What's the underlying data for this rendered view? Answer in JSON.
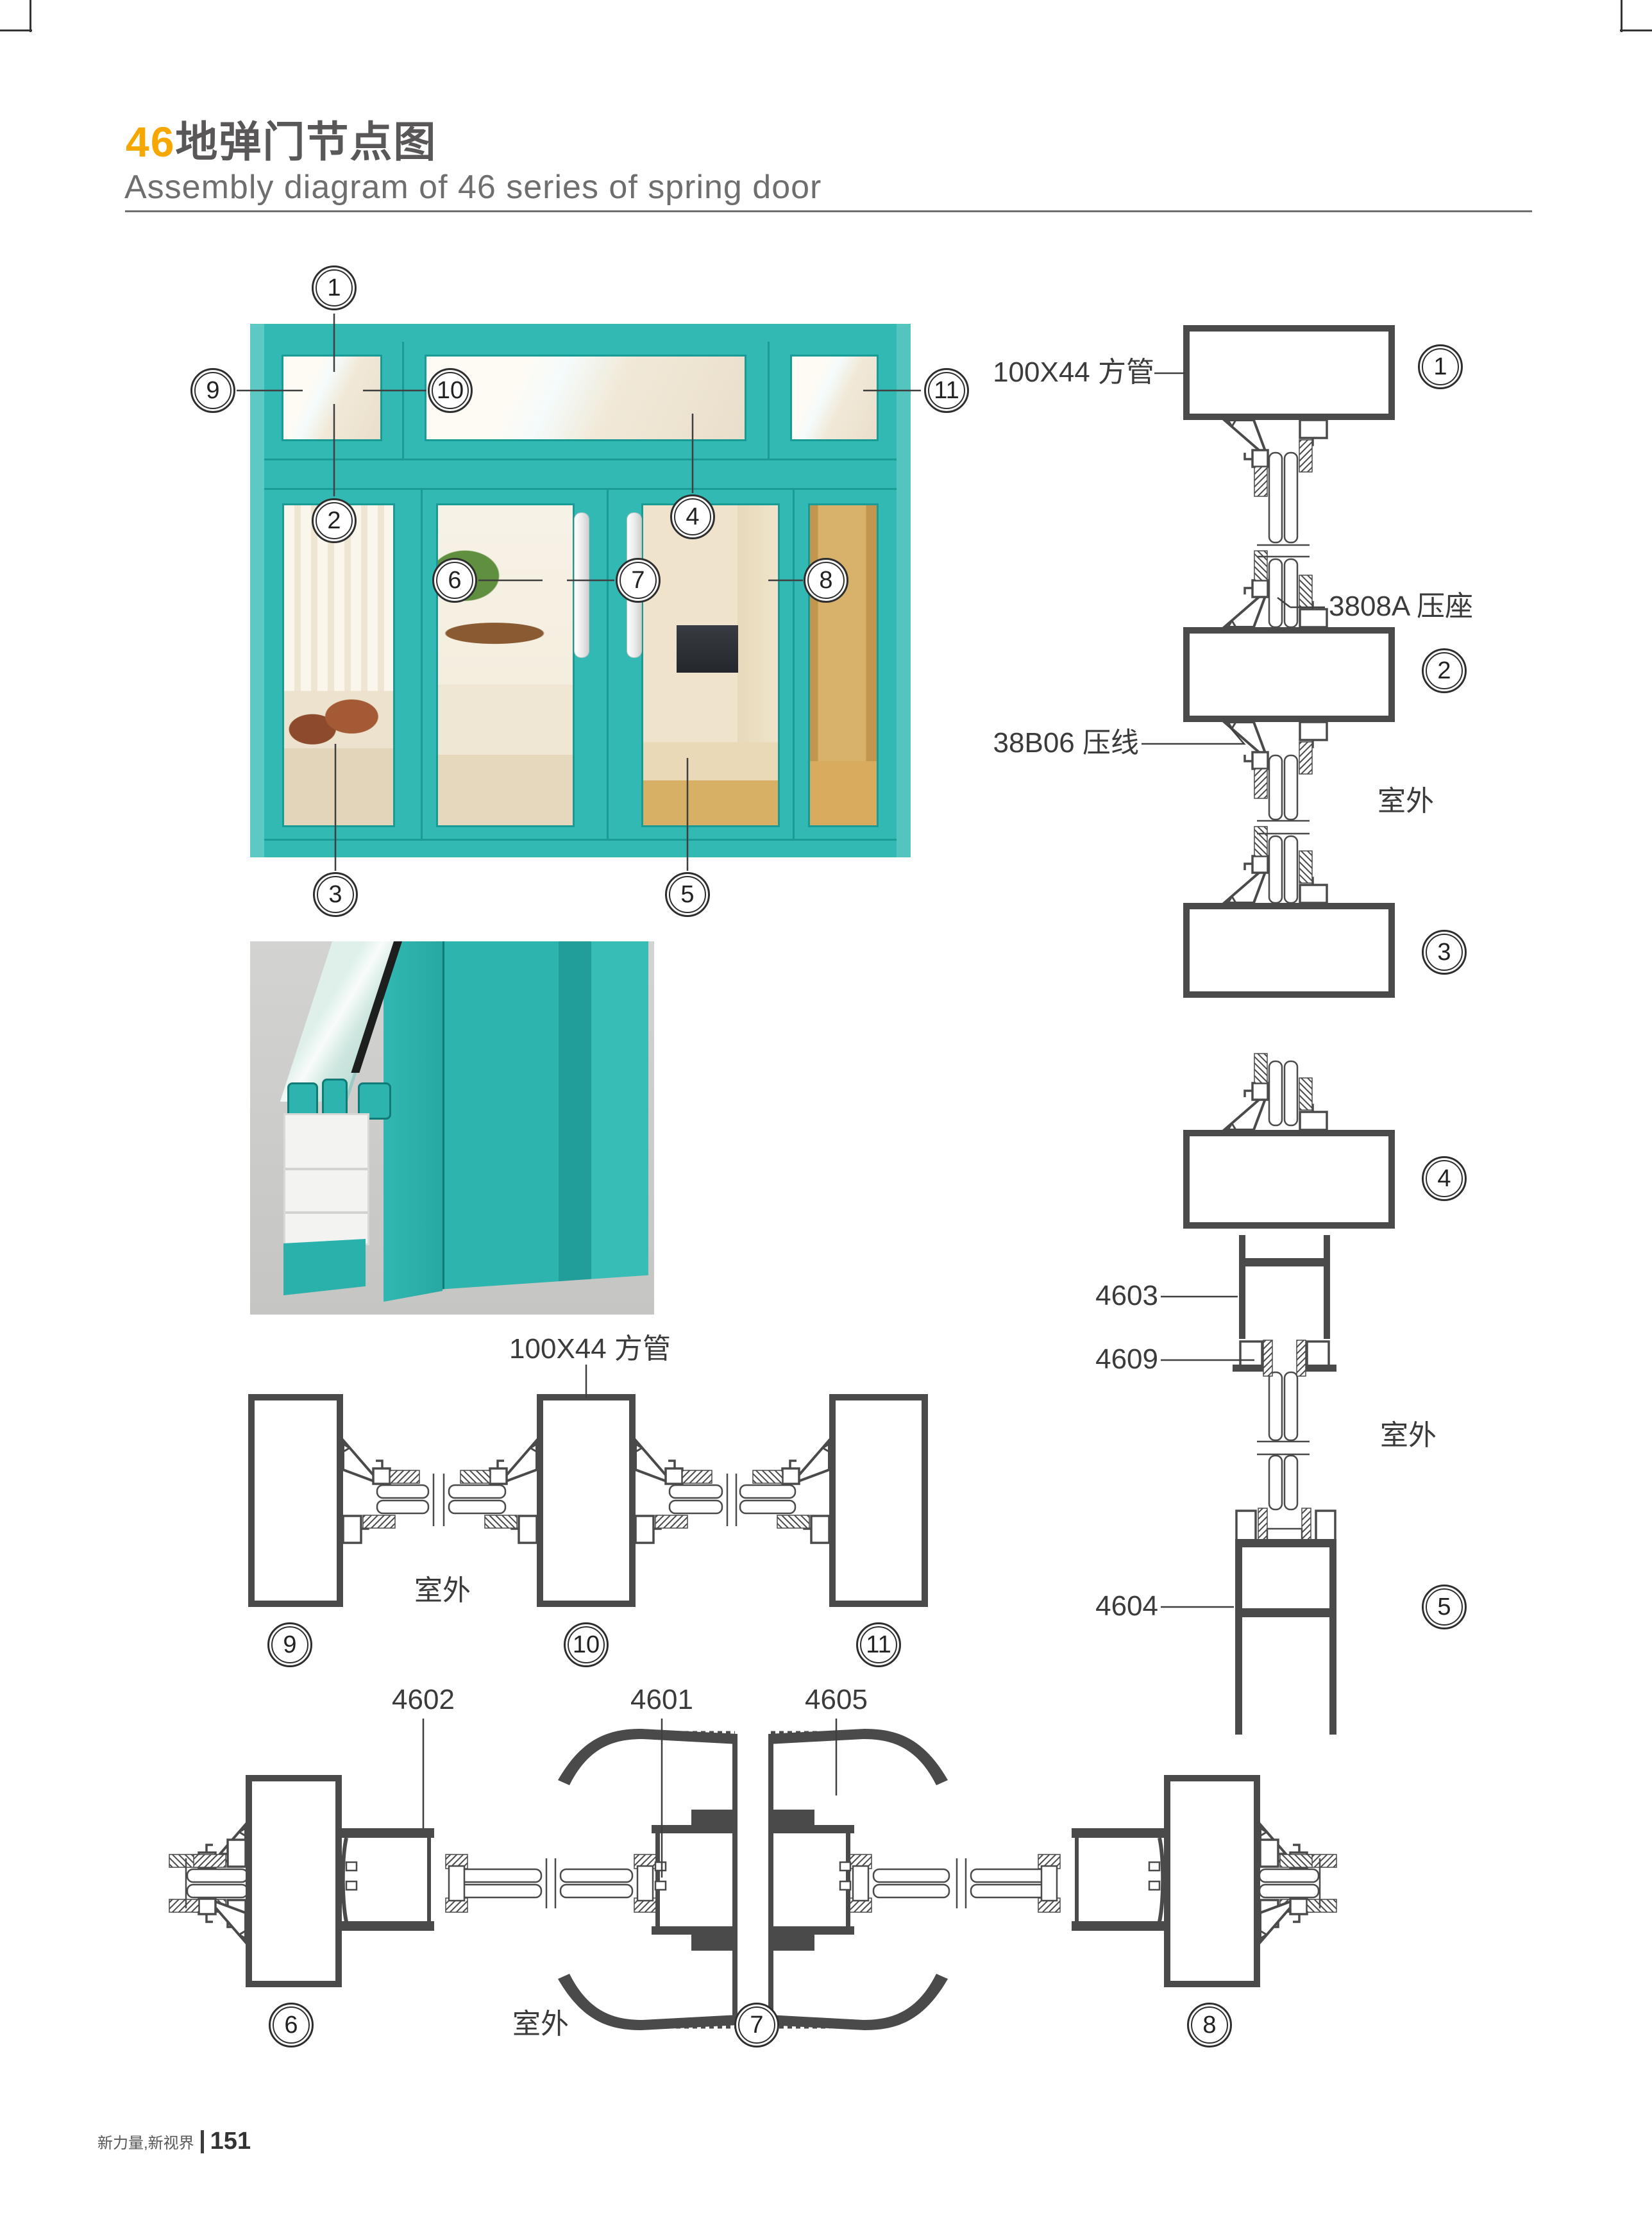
{
  "page": {
    "title_num": "46",
    "title_cn": "地弹门节点图",
    "subtitle": "Assembly diagram of 46 series of spring door"
  },
  "footer": {
    "brand": "新力量,新视界",
    "page_no": "151"
  },
  "colors": {
    "accent_teal": "#32B9B3",
    "title_orange": "#F7A800",
    "drawing_stroke": "#4a4a4a"
  },
  "labels": {
    "tube_right": "100X44 方管",
    "tube_bottom": "100X44 方管",
    "seat_3808a": "3808A 压座",
    "bead_38b06": "38B06 压线",
    "outdoor_right_upper": "室外",
    "outdoor_right_lower": "室外",
    "outdoor_mid": "室外",
    "outdoor_bottom": "室外",
    "p4603": "4603",
    "p4609": "4609",
    "p4604": "4604",
    "p4602": "4602",
    "p4601": "4601",
    "p4605": "4605"
  },
  "callouts": {
    "n1": "1",
    "n2": "2",
    "n3": "3",
    "n4": "4",
    "n5": "5",
    "n6": "6",
    "n7": "7",
    "n8": "8",
    "n9": "9",
    "n10": "10",
    "n11": "11"
  }
}
